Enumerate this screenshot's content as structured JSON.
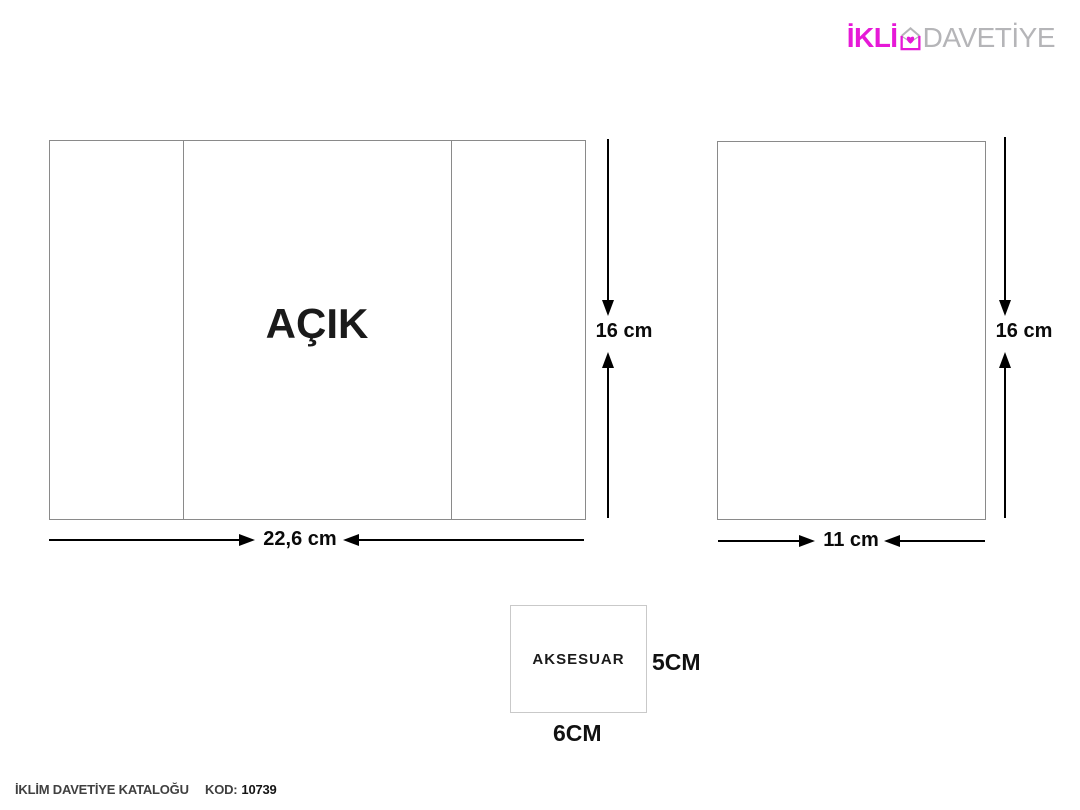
{
  "logo": {
    "part1": "İKLİ",
    "m_letter": "M",
    "part2": "DAVETİYE",
    "brand_color": "#e619d7",
    "secondary_color": "#b5b5b8"
  },
  "open_card": {
    "label": "AÇIK",
    "width_label": "22,6 cm",
    "height_label": "16 cm"
  },
  "envelope_card": {
    "width_label": "11 cm",
    "height_label": "16 cm"
  },
  "accessory": {
    "label": "AKSESUAR",
    "width_label": "6CM",
    "height_label": "5CM"
  },
  "footer": {
    "catalog_title": "İKLİM DAVETİYE KATALOĞU",
    "code_label": "KOD:",
    "code_value": "10739"
  }
}
